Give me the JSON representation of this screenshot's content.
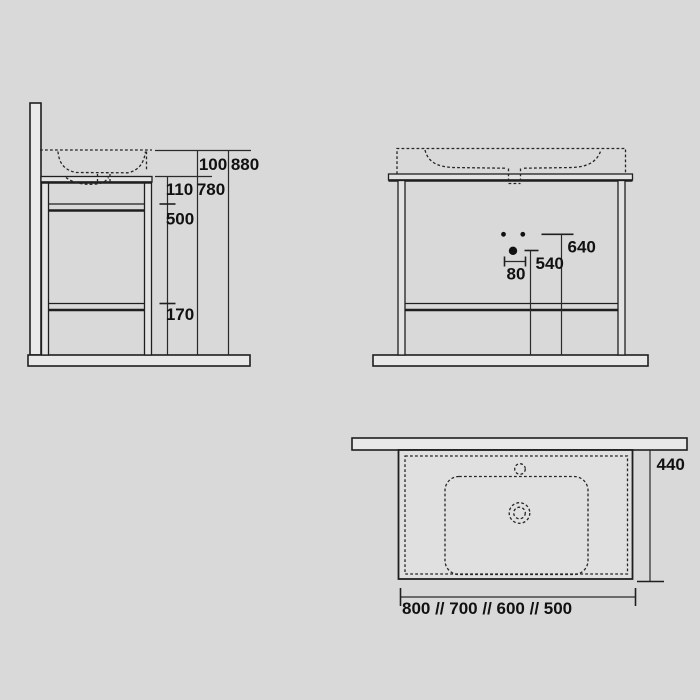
{
  "drawing": {
    "type": "washbasin-console-dimension-drawing",
    "colors": {
      "background": "#d9d9d9",
      "line": "#1f1f1f",
      "dimension_line": "#2a2a2a",
      "bar_fill": "#e9e9e9",
      "panel_fill": "#e0e0e0",
      "label_text": "#111111"
    },
    "views": {
      "side_elevation": {
        "dim_100": "100",
        "dim_880": "880",
        "dim_110": "110",
        "dim_780": "780",
        "dim_500": "500",
        "dim_170": "170"
      },
      "front_elevation": {
        "dim_640": "640",
        "dim_540": "540",
        "dim_80": "80"
      },
      "top_plan": {
        "dim_440": "440",
        "dim_widths": "800 // 700 // 600 // 500"
      }
    }
  }
}
